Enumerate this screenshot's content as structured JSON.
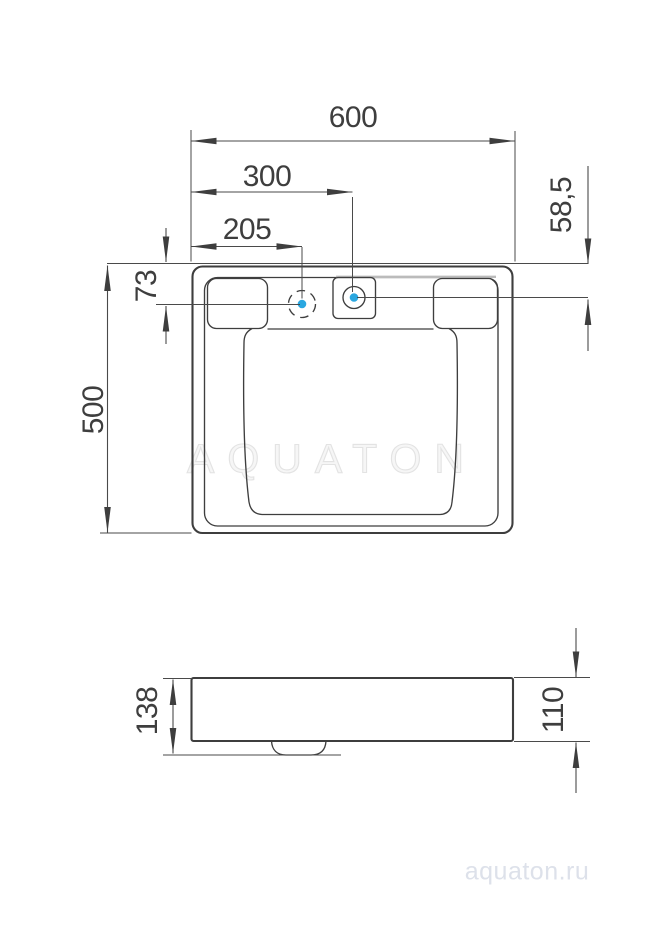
{
  "drawing": {
    "colors": {
      "line": "#3e3e3e",
      "dimension_line": "#4a4a4a",
      "accent_dot": "#2aa7e0",
      "shade_line": "#bbbbbb",
      "watermark_outline": "#e3e3e3",
      "footer_text": "#dde1ea"
    },
    "top_view": {
      "dim_width": "600",
      "dim_hole_offset": "300",
      "dim_alt_hole_offset": "205",
      "dim_hole_from_edge": "58,5",
      "dim_alt_hole_from_edge": "73",
      "dim_depth": "500"
    },
    "side_view": {
      "dim_height_total": "138",
      "dim_height_front": "110"
    },
    "watermark_text": "AQUATON",
    "footer_site": "aquaton.ru"
  }
}
